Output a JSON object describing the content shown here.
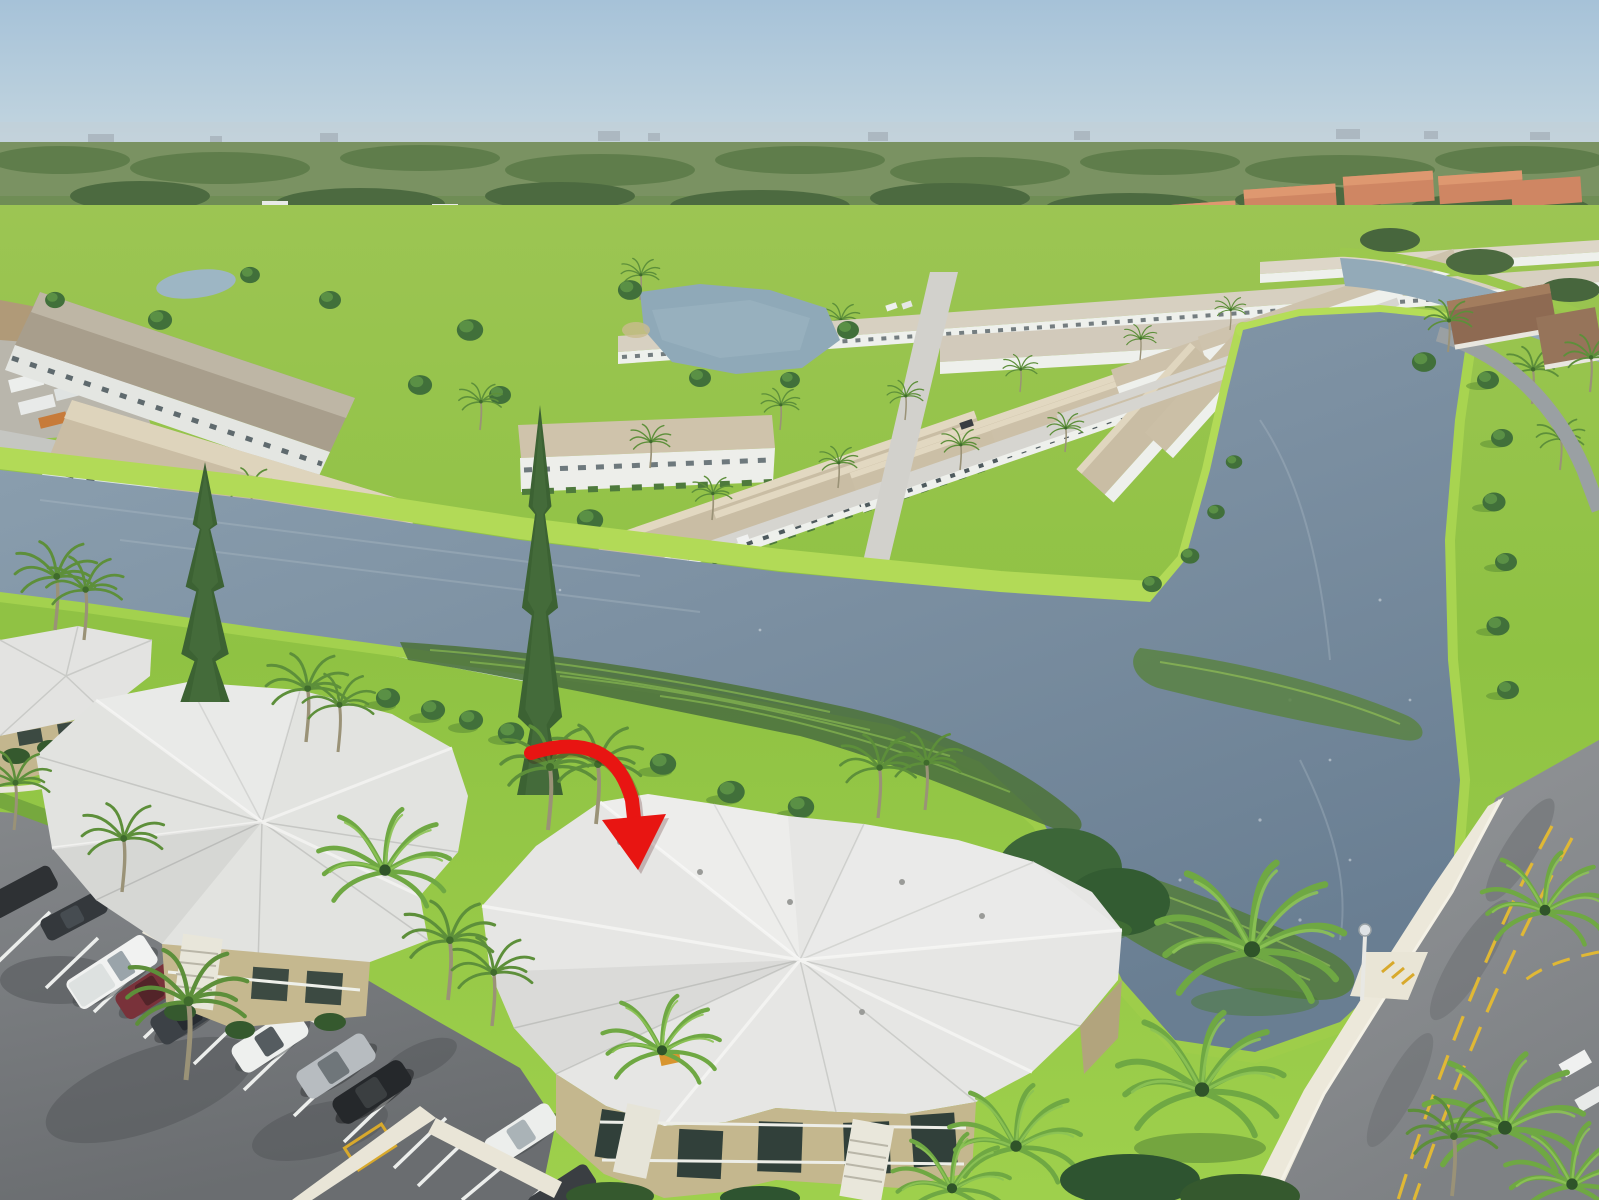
{
  "meta": {
    "kind": "aerial-drone-photograph",
    "subject": "waterfront condo community with lakes, lawns, palms and a highlighted building",
    "highlight": "red curved arrow pointing at the roof of the center two-story condo building"
  },
  "annotation": {
    "type": "curved-arrow",
    "color": "#e81512",
    "shadow_color": "rgba(70,0,0,0.22)",
    "target": "center-condo-roof"
  },
  "palette": {
    "sky_top": "#a6c2d8",
    "sky_horizon": "#cfdde6",
    "haze": "#c2cfd7",
    "far_trees": "#60804c",
    "far_trees_dark": "#4c6a40",
    "lawn": "#8fc243",
    "lawn_bright": "#aeda55",
    "lawn_shadow": "#5d8f35",
    "water_far": "#8fa3b2",
    "water_near": "#697e92",
    "marsh_dark": "#4f7440",
    "marsh_light": "#85b152",
    "roof_tan": "#c9bda4",
    "roof_tan_ridge": "#e2d8c1",
    "roof_gray_long": "#a89e8c",
    "roof_white": "#e6e6e4",
    "roof_white_shade": "#cbccc9",
    "wall_tan": "#c4b78e",
    "wall_white": "#eef0ec",
    "wall_teal": "#cfe0da",
    "asphalt_road": "#8e9194",
    "asphalt_lot": "#7e8184",
    "concrete": "#e9e5d7",
    "stripe_white": "#eceeec",
    "line_yellow": "#e0b835",
    "tile_red": "#cf8663",
    "pine_green": "#3c6233",
    "palm_green": "#5d8f3a",
    "palm_bright": "#8cc355",
    "trunk": "#9a9277"
  },
  "vehicles": {
    "parking_row": [
      {
        "type": "pickup-truck",
        "color": "#f1f2f1"
      },
      {
        "type": "suv",
        "color": "#79323a"
      },
      {
        "type": "suv",
        "color": "#3c4146"
      },
      {
        "type": "crossover",
        "color": "#eef0ee"
      },
      {
        "type": "suv",
        "color": "#b7bcc0"
      },
      {
        "type": "sedan",
        "color": "#25282b"
      },
      {
        "type": "car",
        "color": "#eceeec"
      },
      {
        "type": "car",
        "color": "#3a3e42"
      },
      {
        "type": "car-partial",
        "color": "#2e3134"
      },
      {
        "type": "car-partial",
        "color": "#34383c"
      }
    ]
  },
  "scene": {
    "foreground_buildings": 3,
    "midground_rows": "tan-roof single story townhome rows",
    "water_bodies": [
      "near canal",
      "large right lake",
      "upper ponds"
    ],
    "road": "diagonal two-lane road with double yellow line, bottom right"
  }
}
